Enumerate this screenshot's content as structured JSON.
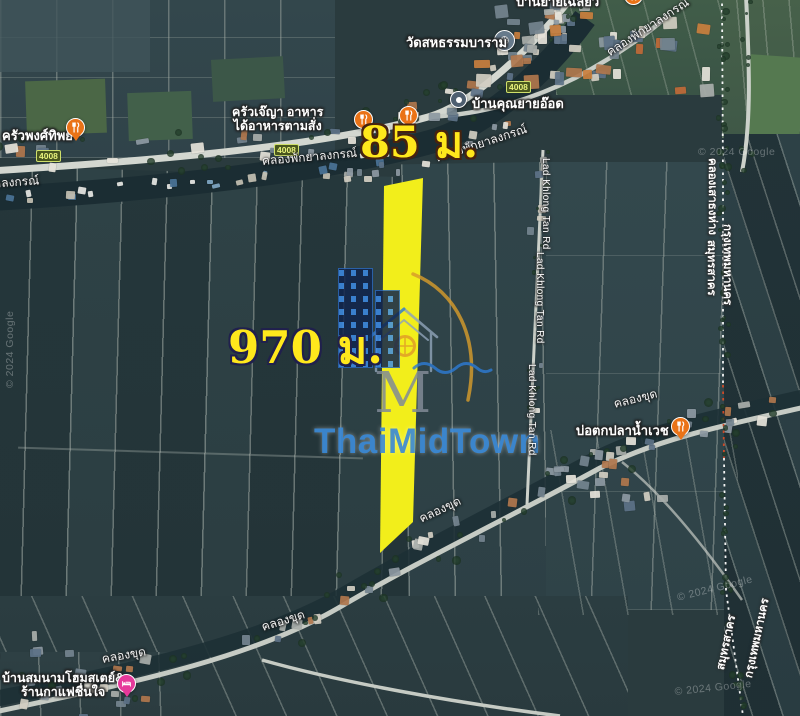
{
  "annotation": {
    "width_label": "85 ม.",
    "length_label": "970 ม.",
    "highlight_color": "#f2ee1b"
  },
  "watermark": {
    "brand": "ThaiMidTown",
    "monogram": "M",
    "brand_color": "#3d8bd8",
    "accent_color": "#d69b2b"
  },
  "route_badge": "4008",
  "roads": {
    "lad_khlong_tan": "Lad Khlong Tan Rd"
  },
  "canals": {
    "phak_ya_longkorn": "คลองพักยาลงกรณ์",
    "khlong_khut": "คลองขุด",
    "border_canal": "คลองเสาธงห่าง"
  },
  "provinces": {
    "samut_sakhon": "สมุทรสาคร",
    "bangkok": "กรุงเทพมหานคร"
  },
  "pois": {
    "temple": {
      "label": "วัดสหธรรมบาราม"
    },
    "ban_khun_yai_ot": {
      "label": "บ้านคุณยายอ๊อด"
    },
    "krua_je_ya": {
      "label_line1": "ครัวเจ๊ญา อาหาร",
      "label_line2": "ได้อาหารตามสั่ง"
    },
    "krua_phong_thip": {
      "label": "ครัวพงศ์ทิพย์"
    },
    "fishing_pond": {
      "label": "บ่อตกปลาน้ำเวช"
    },
    "homestay": {
      "label_line1": "บ้านสมนามโฮมสเตย์&",
      "label_line2": "ร้านกาแฟชื่นใจ"
    },
    "clipped_top": {
      "label": "บ้านยายเฉลียว"
    }
  },
  "attribution": "© 2024 Google",
  "marker_colors": {
    "restaurant": "#ea7317",
    "homestay": "#e6399b",
    "temple": "#677a8b",
    "place": "#4e5f70"
  }
}
